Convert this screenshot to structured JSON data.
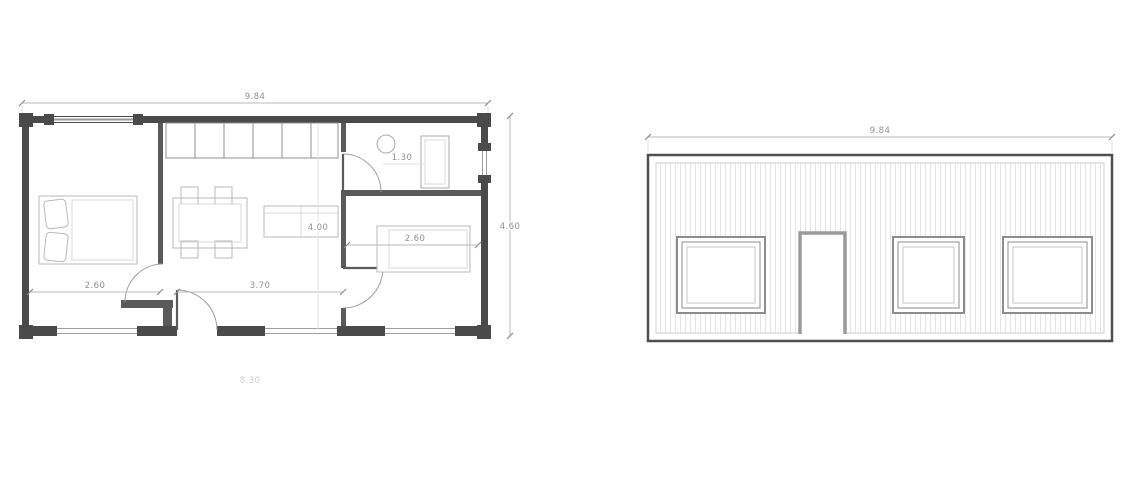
{
  "drawing": {
    "floor_plan": {
      "dim_total_width": "9.84",
      "dim_total_depth": "4.60",
      "dim_bedroom_width": "2.60",
      "dim_hall_width": "3.70",
      "dim_interior_depth": "4.00",
      "dim_bathroom_width": "1.30",
      "dim_bedroom2_width": "2.60",
      "dim_footer": "8.30"
    },
    "elevation": {
      "dim_total_width": "9.84"
    }
  },
  "colors": {
    "wall": "#4a4a4a",
    "partition": "#5a5a5a",
    "dimension_text": "#8f8f8f",
    "furniture_line": "#b8b8b8",
    "facade_stripe": "#e4e4e4",
    "background": "#ffffff"
  }
}
